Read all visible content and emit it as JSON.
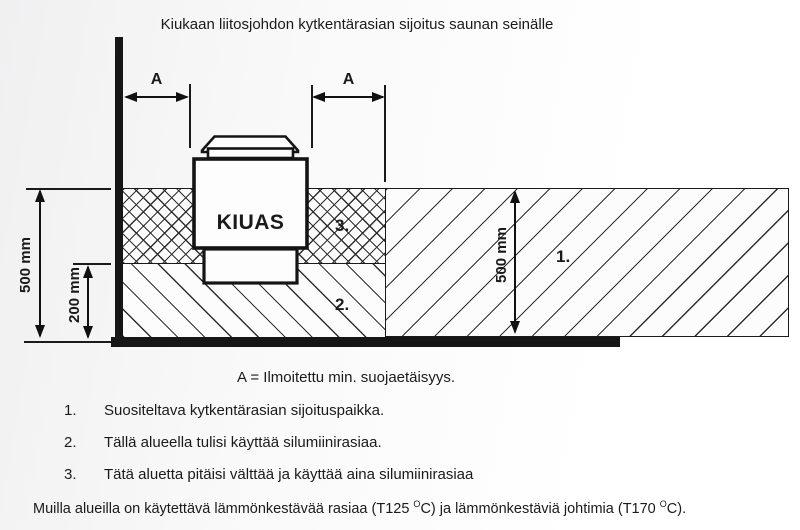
{
  "title": "Kiukaan liitosjohdon kytkentärasian sijoitus saunan seinälle",
  "diagram": {
    "heater_label": "KIUAS",
    "dim_a": "A",
    "dim_left_500": "500 mm",
    "dim_left_200": "200 mm",
    "dim_mid_500": "500 mm",
    "zone_labels": {
      "zone1": "1.",
      "zone2": "2.",
      "zone3": "3."
    }
  },
  "legend": {
    "formula": "A = Ilmoitettu min. suojaetäisyys.",
    "items": [
      {
        "num": "1.",
        "text": "Suositeltava kytkentärasian sijoituspaikka."
      },
      {
        "num": "2.",
        "text": "Tällä alueella tulisi käyttää silumiinirasiaa."
      },
      {
        "num": "3.",
        "text": "Tätä aluetta pitäisi välttää ja käyttää aina silumiinirasiaa"
      }
    ]
  },
  "footer": {
    "part1": "Muilla alueilla on käytettävä lämmönkestävää rasiaa (T125 ",
    "sup1": "O",
    "part2": "C) ja lämmönkestäviä johtimia (T170 ",
    "sup2": "O",
    "part3": "C)."
  },
  "colors": {
    "line": "#161616",
    "background": "#f7f7f7"
  }
}
